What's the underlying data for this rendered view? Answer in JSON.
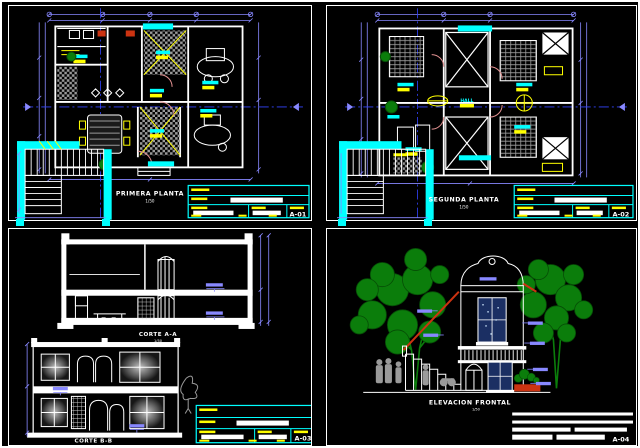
{
  "page": {
    "background": "#000000",
    "border_color": "#ffffff"
  },
  "colors": {
    "line_white": "#ffffff",
    "dimension_violet": "#8888ff",
    "centerline_blue": "#3344ff",
    "label_cyan": "#00ffff",
    "fixture_yellow": "#ffff00",
    "accent_red": "#cc3311",
    "plant_green": "#0b7d0b",
    "hatch_gray": "#9a9a9a",
    "people_gray": "#9a9a9a",
    "window_blue": "#1b2f63",
    "door_arc_pink": "#e09090"
  },
  "sheets": [
    {
      "code": "A-01",
      "title": "PRIMERA PLANTA",
      "scale": "1/50"
    },
    {
      "code": "A-02",
      "title": "SEGUNDA PLANTA",
      "scale": "1/50",
      "room_label": "HALL"
    },
    {
      "code": "A-03",
      "title_a": "CORTE A-A",
      "title_b": "CORTE B-B",
      "scale": "1/50"
    },
    {
      "code": "A-04",
      "title": "ELEVACION FRONTAL",
      "scale": "1/50"
    }
  ]
}
